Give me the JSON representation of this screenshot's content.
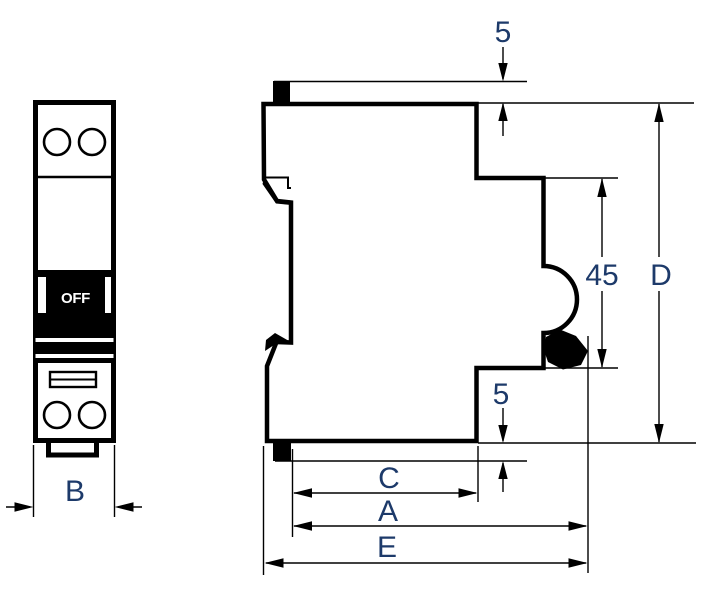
{
  "front_view": {
    "toggle_label": "OFF",
    "width_dim_label": "B"
  },
  "side_view": {
    "top_clip_offset_label": "5",
    "bottom_clip_offset_label": "5",
    "rail_recess_height_label": "45",
    "overall_height_label": "D",
    "depth_c_label": "C",
    "depth_a_label": "A",
    "depth_e_label": "E"
  },
  "colors": {
    "line": "#000000",
    "dim_text": "#1d3a6a",
    "toggle_text": "#ffffff",
    "background": "#ffffff"
  }
}
